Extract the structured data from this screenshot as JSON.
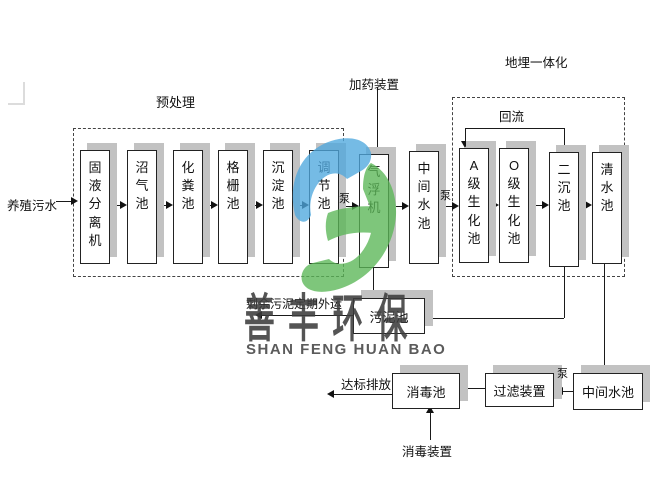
{
  "labels": {
    "influent": "养殖污水",
    "pretreatment": "预处理",
    "dosing_device": "加药装置",
    "buried_integration": "地埋一体化",
    "reflux": "回流",
    "pump": "泵",
    "sludge_note": "剩余污泥定期外运",
    "discharge": "达标排放",
    "disinfection_device": "消毒装置"
  },
  "boxes": {
    "solid_liquid_separator": "固液分离机",
    "biogas_pool": "沼气池",
    "septic_pool": "化粪池",
    "grille_pool": "格栅池",
    "sedimentation_pool": "沉淀池",
    "regulating_pool": "调节池",
    "air_flotation_machine": "气浮机",
    "intermediate_pool_1": "中间水池",
    "a_level_bio_pool": "A级生化池",
    "o_level_bio_pool": "O级生化池",
    "secondary_sedimentation_pool": "二沉池",
    "clear_water_pool": "清水池",
    "sludge_pool": "污泥池",
    "disinfection_pool": "消毒池",
    "filter_device": "过滤装置",
    "intermediate_pool_2": "中间水池"
  },
  "watermark": {
    "cn": "善丰环保",
    "en": "SHAN FENG HUAN BAO",
    "logo_blue": "#4FA8DE",
    "logo_green": "#5BB757"
  }
}
